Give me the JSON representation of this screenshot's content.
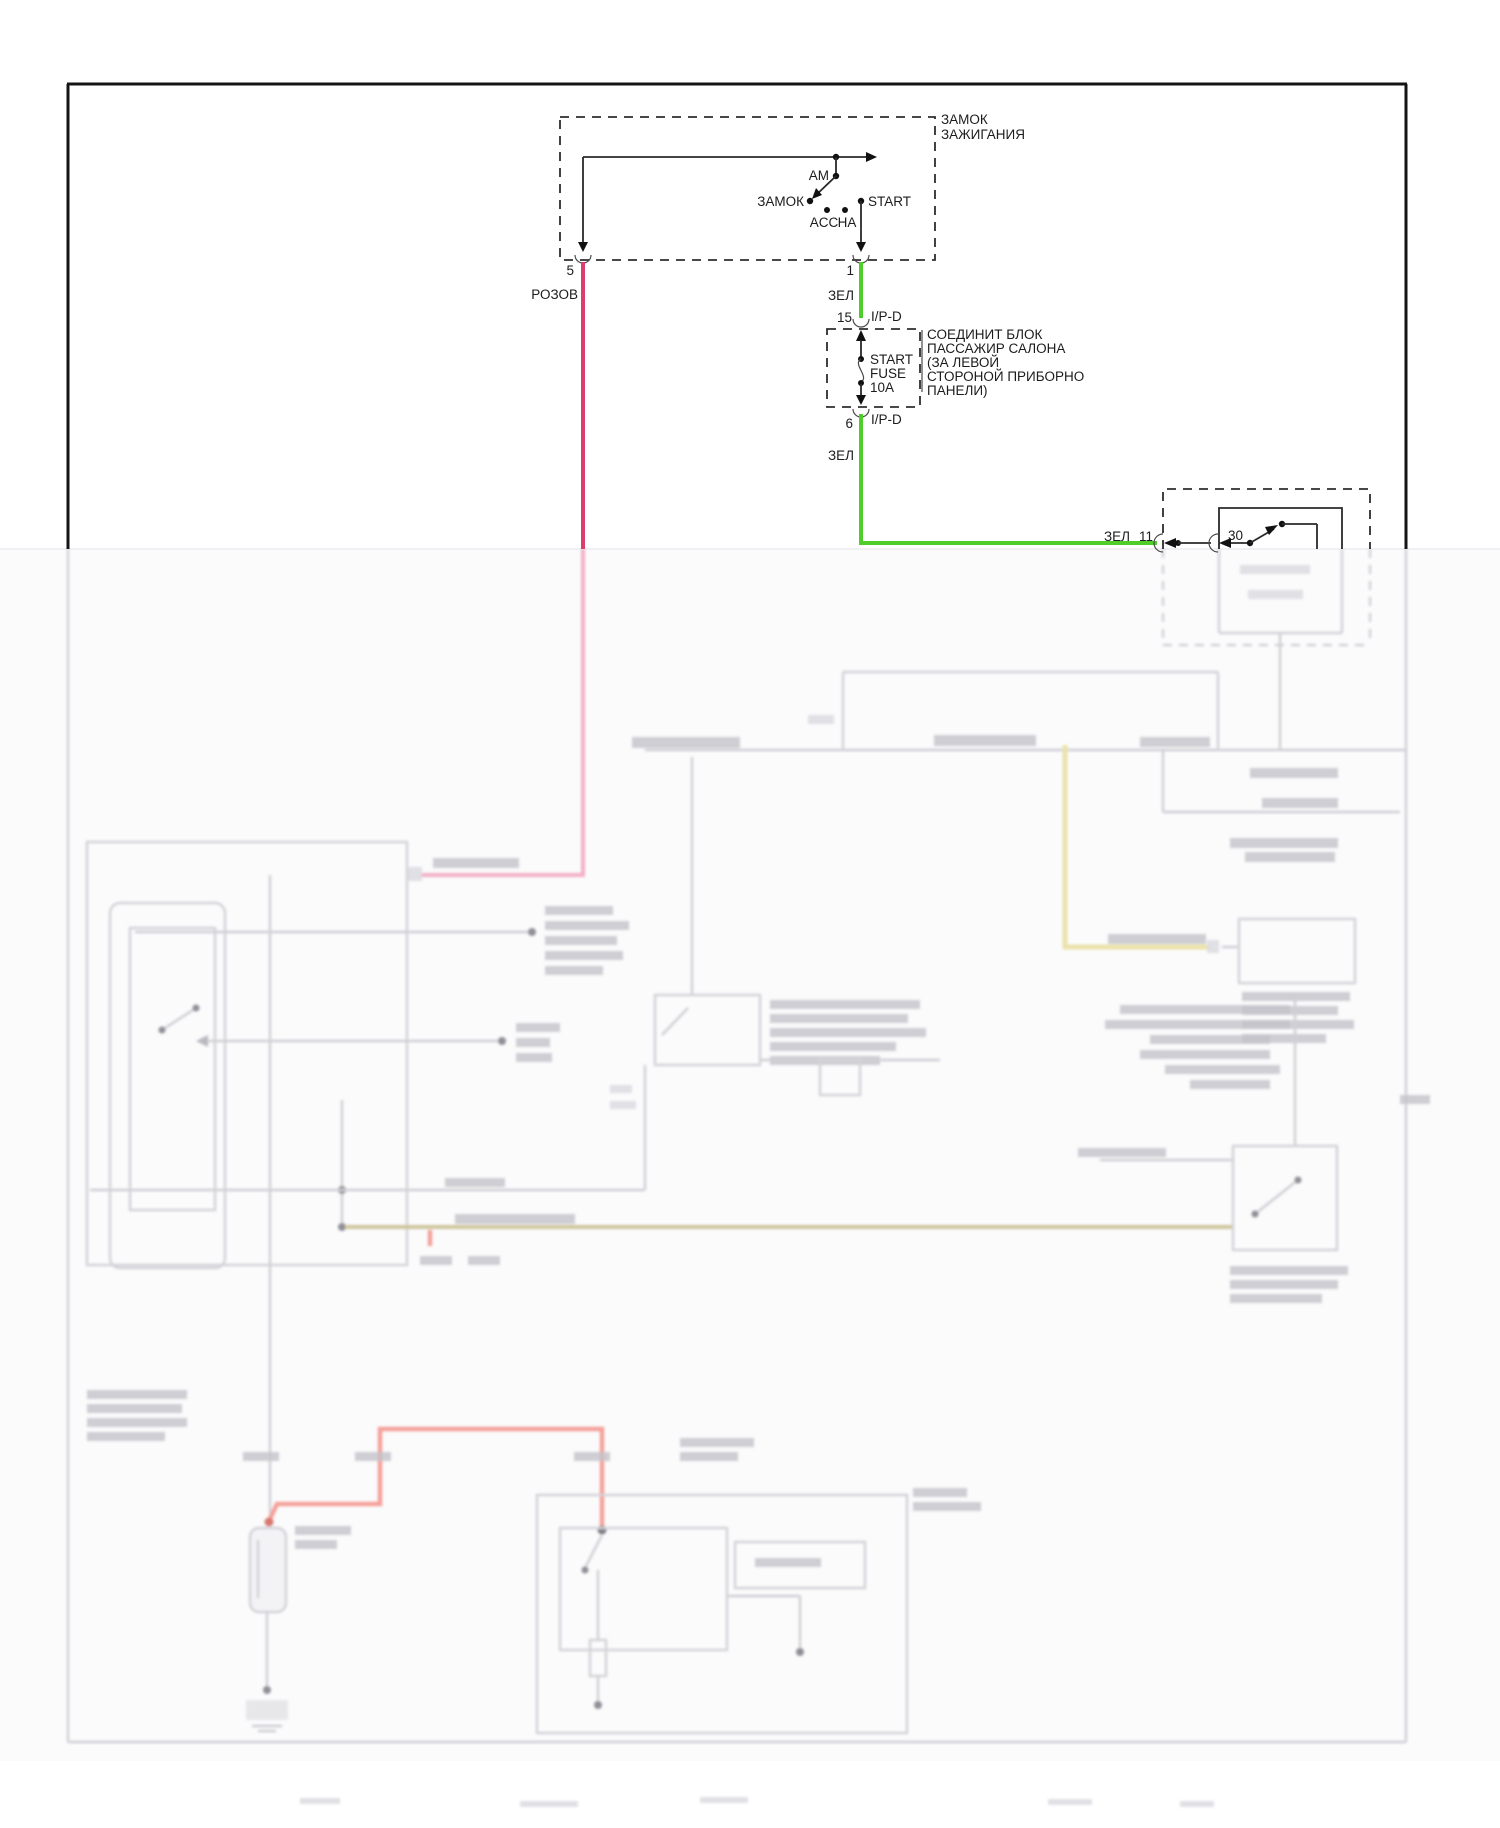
{
  "ignition_switch": {
    "title_line1": "ЗАМОК",
    "title_line2": "ЗАЖИГАНИЯ",
    "terminal_am": "AM",
    "terminal_lock": "ЗАМОК",
    "terminal_acc": "ACC",
    "terminal_ha": "НА",
    "terminal_start": "START",
    "pin_5": "5",
    "pin_1": "1"
  },
  "wires": {
    "pink_label": "РОЗОВ",
    "green_label_top": "ЗЕЛ",
    "green_label_mid": "ЗЕЛ",
    "green_label_right": "ЗЕЛ",
    "green_pin_11": "11",
    "colors": {
      "green": "#4fce2b",
      "pink": "#dd3e6e",
      "faded_pink": "#f3aec5",
      "faded_yellow": "#ebe2a9",
      "faded_olive": "#cdc69c",
      "faded_red": "#f4a19a"
    }
  },
  "fuse_block": {
    "pin_in": "15",
    "connector_in": "I/P-D",
    "pin_out": "6",
    "connector_out": "I/P-D",
    "fuse_line1": "START",
    "fuse_line2": "FUSE",
    "fuse_rating": "10A",
    "note_line1": "СОЕДИНИТ БЛОК",
    "note_line2": "ПАССАЖИР САЛОНА",
    "note_line3": "(ЗА ЛЕВОЙ",
    "note_line4": "СТОРОНОЙ ПРИБОРНО",
    "note_line5": "ПАНЕЛИ)"
  },
  "starter_relay": {
    "pin_30": "30"
  }
}
